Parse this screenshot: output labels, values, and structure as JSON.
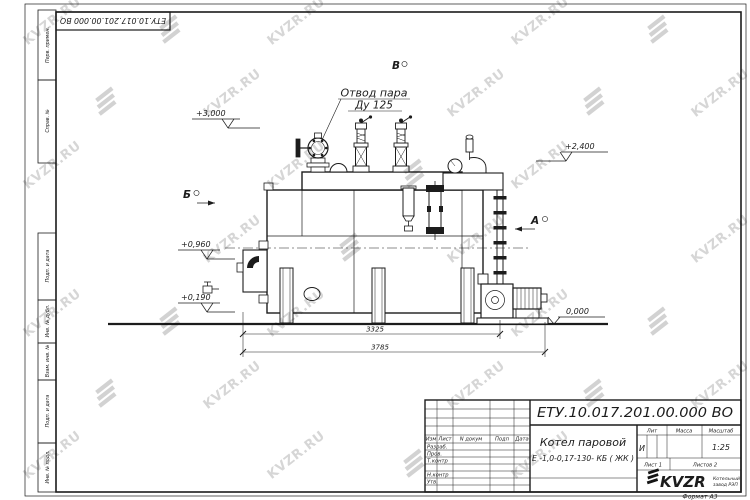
{
  "sheet": {
    "doc_number_top": "ЕТУ.10.017.201.00.000  ВО",
    "format_label": "Формат А3",
    "watermark_text": "KVZR.RU"
  },
  "side_stamps": {
    "perv_primen": "Перв. примен.",
    "sprav_no": "Справ. №",
    "podp_data_1": "Подп. и дата",
    "inv_dubl": "Инв. № дубл.",
    "vzam_inv": "Взам. инв. №",
    "podp_data_2": "Подп. и дата",
    "inv_podl": "Инв. № подл."
  },
  "drawing": {
    "callout": {
      "line1": "Отвод пара",
      "line2": "Ду 125"
    },
    "views": {
      "a": "А",
      "b": "Б",
      "v": "В"
    },
    "elevations": {
      "e3000": "+3,000",
      "e2400": "+2,400",
      "e0960": "+0,960",
      "e0190": "+0,190",
      "e0000": "0,000"
    },
    "dimensions": {
      "inner": "3325",
      "overall": "3785"
    }
  },
  "title_block": {
    "doc_number": "ЕТУ.10.017.201.00.000  ВО",
    "name_line1": "Котел паровой",
    "name_line2": "Е -1,0-0,17-130- КБ ( ЖК )",
    "cols": {
      "izm": "Изм",
      "list": "Лист",
      "n_dokum": "N докум",
      "podp": "Подп",
      "data": "Дата"
    },
    "rows": {
      "razrab": "Разраб.",
      "prov": "Пров.",
      "tkontr": "Т.контр",
      "nkontr": "Н.контр",
      "utv": "Утв."
    },
    "lit": {
      "label": "Лит",
      "value": "И"
    },
    "massa": {
      "label": "Масса"
    },
    "masshtab": {
      "label": "Масштаб",
      "value": "1:25"
    },
    "sheet_no": "Лист 1",
    "sheets_total": "Листов 2",
    "logo": {
      "text": "KVZR",
      "sub1": "Котельный",
      "sub2": "завод РЭП"
    }
  },
  "colors": {
    "line": "#1c1c1c",
    "watermark": "#b4b4b4",
    "logo_sub": "#8a5040"
  }
}
